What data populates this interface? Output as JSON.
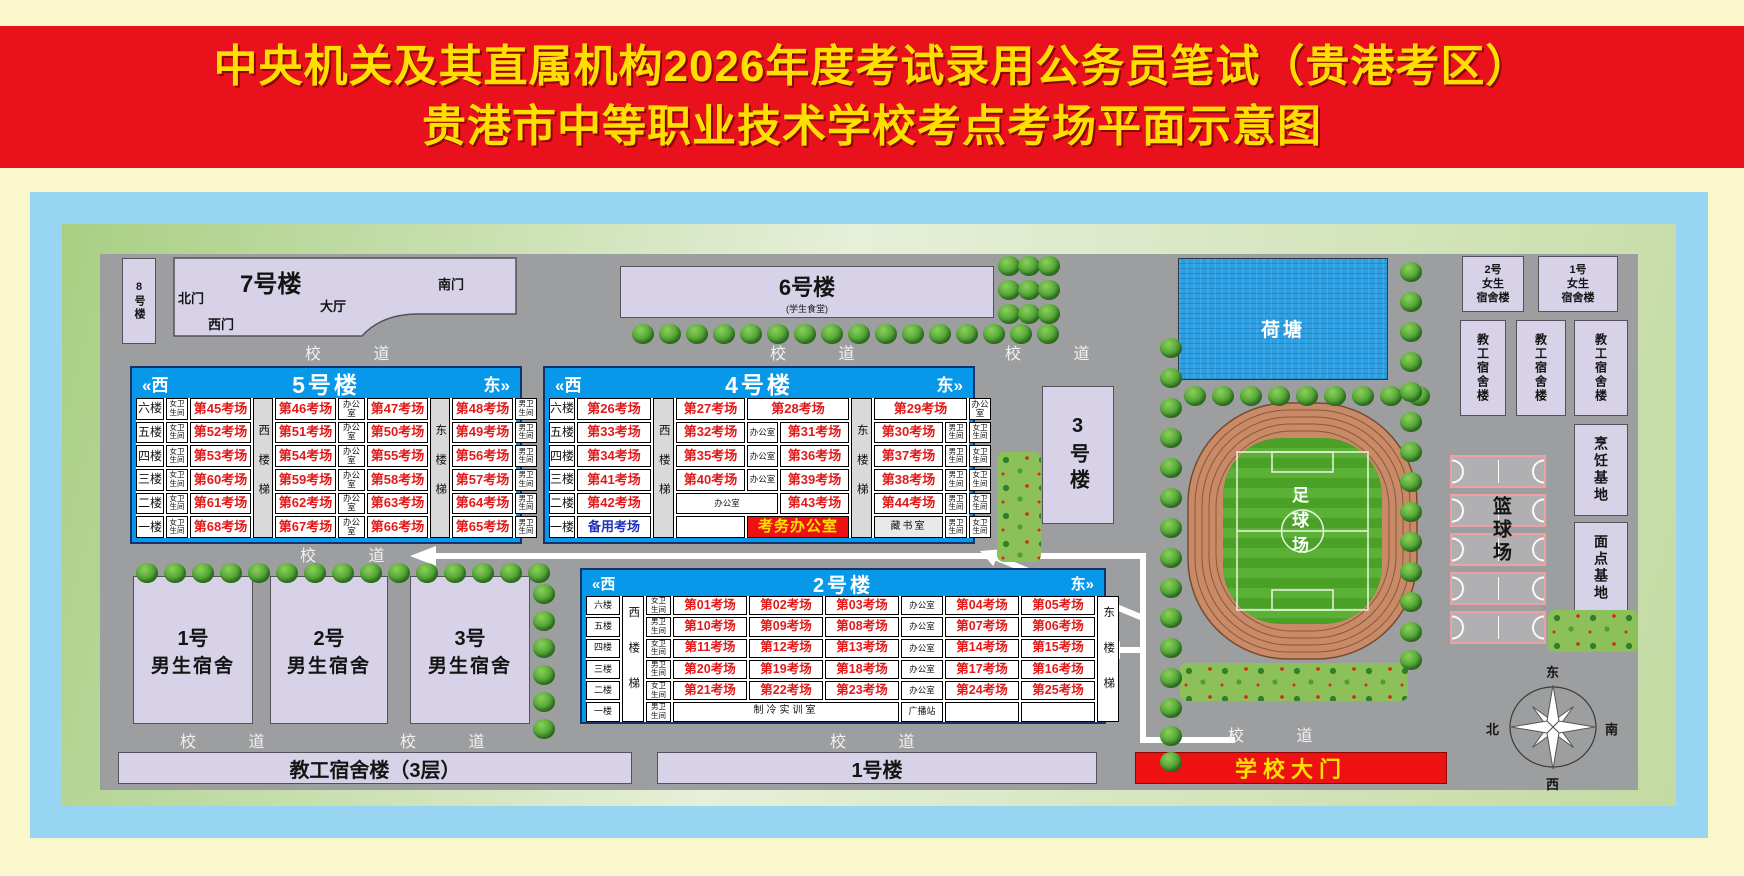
{
  "title": {
    "line1": "中央机关及其直属机构2026年度考试录用公务员笔试（贵港考区）",
    "line2": "贵港市中等职业技术学校考点考场平面示意图"
  },
  "road_label": "校 道",
  "compass": {
    "east": "东",
    "north": "北",
    "south": "南",
    "west": "西"
  },
  "colors": {
    "banner_red": "#E9121C",
    "title_yellow": "#FFDF00",
    "table_blue": "#0898EA",
    "room_red": "#E21A1A",
    "gate_red": "#ED1111",
    "building_fill": "#D7D2E7",
    "campus_gray": "#9C9EA0"
  },
  "buildings": {
    "b8": "8号楼",
    "b7": "7号楼",
    "b7_north_gate": "北门",
    "b7_west_gate": "西门",
    "b7_hall": "大厅",
    "b7_south_gate": "南门",
    "b6": "6号楼",
    "b6_note": "(学生食堂)",
    "b3": "3号楼",
    "pond": "荷塘",
    "football_field": "足球场",
    "basketball_court": "篮球场",
    "dorm_m1_no": "1号",
    "dorm_m2_no": "2号",
    "dorm_m3_no": "3号",
    "dorm_m_label": "男生宿舍",
    "dorm_f1_no": "1号",
    "dorm_f2_no": "2号",
    "dorm_f_line2": "女生",
    "dorm_f_line3": "宿舍楼",
    "staff_dorm": "教工宿舍楼",
    "cooking_base": "烹饪基地",
    "pastry_base": "面点基地",
    "teacher_dorm_bar": "教工宿舍楼（3层）",
    "b1_bar": "1号楼",
    "school_gate": "学校大门"
  },
  "b5": {
    "name": "5号楼",
    "west": "«西",
    "east": "东»",
    "cols": [
      28,
      22,
      61,
      20,
      61,
      27,
      61,
      20,
      61,
      22
    ],
    "stairs": [
      {
        "col": 4,
        "t": "西楼梯"
      },
      {
        "col": 8,
        "t": "东楼梯"
      }
    ],
    "rows": [
      [
        {
          "c": 1,
          "k": "floor",
          "t": "六楼"
        },
        {
          "c": 2,
          "k": "wc",
          "t": "女卫生间"
        },
        {
          "c": 3,
          "k": "room",
          "t": "第45考场"
        },
        {
          "c": 5,
          "k": "room",
          "t": "第46考场"
        },
        {
          "c": 6,
          "k": "office",
          "t": "办公室"
        },
        {
          "c": 7,
          "k": "room",
          "t": "第47考场"
        },
        {
          "c": 9,
          "k": "room",
          "t": "第48考场"
        },
        {
          "c": 10,
          "k": "wc",
          "t": "男卫生间"
        }
      ],
      [
        {
          "c": 1,
          "k": "floor",
          "t": "五楼"
        },
        {
          "c": 2,
          "k": "wc",
          "t": "女卫生间"
        },
        {
          "c": 3,
          "k": "room",
          "t": "第52考场"
        },
        {
          "c": 5,
          "k": "room",
          "t": "第51考场"
        },
        {
          "c": 6,
          "k": "office",
          "t": "办公室"
        },
        {
          "c": 7,
          "k": "room",
          "t": "第50考场"
        },
        {
          "c": 9,
          "k": "room",
          "t": "第49考场"
        },
        {
          "c": 10,
          "k": "wc",
          "t": "男卫生间"
        }
      ],
      [
        {
          "c": 1,
          "k": "floor",
          "t": "四楼"
        },
        {
          "c": 2,
          "k": "wc",
          "t": "女卫生间"
        },
        {
          "c": 3,
          "k": "room",
          "t": "第53考场"
        },
        {
          "c": 5,
          "k": "room",
          "t": "第54考场"
        },
        {
          "c": 6,
          "k": "office",
          "t": "办公室"
        },
        {
          "c": 7,
          "k": "room",
          "t": "第55考场"
        },
        {
          "c": 9,
          "k": "room",
          "t": "第56考场"
        },
        {
          "c": 10,
          "k": "wc",
          "t": "男卫生间"
        }
      ],
      [
        {
          "c": 1,
          "k": "floor",
          "t": "三楼"
        },
        {
          "c": 2,
          "k": "wc",
          "t": "女卫生间"
        },
        {
          "c": 3,
          "k": "room",
          "t": "第60考场"
        },
        {
          "c": 5,
          "k": "room",
          "t": "第59考场"
        },
        {
          "c": 6,
          "k": "office",
          "t": "办公室"
        },
        {
          "c": 7,
          "k": "room",
          "t": "第58考场"
        },
        {
          "c": 9,
          "k": "room",
          "t": "第57考场"
        },
        {
          "c": 10,
          "k": "wc",
          "t": "男卫生间"
        }
      ],
      [
        {
          "c": 1,
          "k": "floor",
          "t": "二楼"
        },
        {
          "c": 2,
          "k": "wc",
          "t": "女卫生间"
        },
        {
          "c": 3,
          "k": "room",
          "t": "第61考场"
        },
        {
          "c": 5,
          "k": "room",
          "t": "第62考场"
        },
        {
          "c": 6,
          "k": "office",
          "t": "办公室"
        },
        {
          "c": 7,
          "k": "room",
          "t": "第63考场"
        },
        {
          "c": 9,
          "k": "room",
          "t": "第64考场"
        },
        {
          "c": 10,
          "k": "wc",
          "t": "男卫生间"
        }
      ],
      [
        {
          "c": 1,
          "k": "floor",
          "t": "一楼"
        },
        {
          "c": 2,
          "k": "wc",
          "t": "女卫生间"
        },
        {
          "c": 3,
          "k": "room",
          "t": "第68考场"
        },
        {
          "c": 5,
          "k": "room",
          "t": "第67考场"
        },
        {
          "c": 6,
          "k": "office",
          "t": "办公室"
        },
        {
          "c": 7,
          "k": "room",
          "t": "第66考场"
        },
        {
          "c": 9,
          "k": "room",
          "t": "第65考场"
        },
        {
          "c": 10,
          "k": "wc",
          "t": "男卫生间"
        }
      ]
    ]
  },
  "b4": {
    "name": "4号楼",
    "west": "«西",
    "east": "东»",
    "cols": [
      26,
      74,
      21,
      69,
      31,
      69,
      21,
      69,
      22,
      22
    ],
    "stairs": [
      {
        "col": 3,
        "t": "西楼梯"
      },
      {
        "col": 7,
        "t": "东楼梯"
      }
    ],
    "rows": [
      [
        {
          "c": 1,
          "k": "floor",
          "t": "六楼"
        },
        {
          "c": 2,
          "k": "room",
          "t": "第26考场"
        },
        {
          "c": 4,
          "k": "room",
          "t": "第27考场"
        },
        {
          "c": 5,
          "s": 2,
          "k": "room",
          "t": "第28考场"
        },
        {
          "c": 8,
          "s": 2,
          "k": "room",
          "t": "第29考场"
        },
        {
          "c": 10,
          "k": "office",
          "t": "办公室"
        }
      ],
      [
        {
          "c": 1,
          "k": "floor",
          "t": "五楼"
        },
        {
          "c": 2,
          "k": "room",
          "t": "第33考场"
        },
        {
          "c": 4,
          "k": "room",
          "t": "第32考场"
        },
        {
          "c": 5,
          "k": "office",
          "t": "办公室"
        },
        {
          "c": 6,
          "k": "room",
          "t": "第31考场"
        },
        {
          "c": 8,
          "k": "room",
          "t": "第30考场"
        },
        {
          "c": 9,
          "k": "wc",
          "t": "男卫生间"
        },
        {
          "c": 10,
          "k": "wc",
          "t": "女卫生间"
        }
      ],
      [
        {
          "c": 1,
          "k": "floor",
          "t": "四楼"
        },
        {
          "c": 2,
          "k": "room",
          "t": "第34考场"
        },
        {
          "c": 4,
          "k": "room",
          "t": "第35考场"
        },
        {
          "c": 5,
          "k": "office",
          "t": "办公室"
        },
        {
          "c": 6,
          "k": "room",
          "t": "第36考场"
        },
        {
          "c": 8,
          "k": "room",
          "t": "第37考场"
        },
        {
          "c": 9,
          "k": "wc",
          "t": "男卫生间"
        },
        {
          "c": 10,
          "k": "wc",
          "t": "女卫生间"
        }
      ],
      [
        {
          "c": 1,
          "k": "floor",
          "t": "三楼"
        },
        {
          "c": 2,
          "k": "room",
          "t": "第41考场"
        },
        {
          "c": 4,
          "k": "room",
          "t": "第40考场"
        },
        {
          "c": 5,
          "k": "office",
          "t": "办公室"
        },
        {
          "c": 6,
          "k": "room",
          "t": "第39考场"
        },
        {
          "c": 8,
          "k": "room",
          "t": "第38考场"
        },
        {
          "c": 9,
          "k": "wc",
          "t": "男卫生间"
        },
        {
          "c": 10,
          "k": "wc",
          "t": "女卫生间"
        }
      ],
      [
        {
          "c": 1,
          "k": "floor",
          "t": "二楼"
        },
        {
          "c": 2,
          "k": "room",
          "t": "第42考场"
        },
        {
          "c": 4,
          "s": 2,
          "k": "office",
          "t": "办公室"
        },
        {
          "c": 6,
          "k": "room",
          "t": "第43考场"
        },
        {
          "c": 8,
          "k": "room",
          "t": "第44考场"
        },
        {
          "c": 9,
          "k": "wc",
          "t": "男卫生间"
        },
        {
          "c": 10,
          "k": "wc",
          "t": "女卫生间"
        }
      ],
      [
        {
          "c": 1,
          "k": "floor",
          "t": "一楼"
        },
        {
          "c": 2,
          "k": "reserve",
          "t": "备用考场"
        },
        {
          "c": 4,
          "k": "blank",
          "t": ""
        },
        {
          "c": 5,
          "s": 2,
          "k": "kaowu",
          "t": "考务办公室"
        },
        {
          "c": 8,
          "k": "library",
          "t": "藏书室"
        },
        {
          "c": 9,
          "k": "wc",
          "t": "男卫生间"
        },
        {
          "c": 10,
          "k": "wc",
          "t": "女卫生间"
        }
      ]
    ]
  },
  "b2": {
    "name": "2号楼",
    "west": "«西",
    "east": "东»",
    "cols": [
      34,
      22,
      25,
      74,
      74,
      74,
      42,
      74,
      74,
      22
    ],
    "stairs": [
      {
        "col": 2,
        "t": "西楼梯"
      },
      {
        "col": 10,
        "t": "东楼梯"
      }
    ],
    "rows": [
      [
        {
          "c": 1,
          "k": "floor",
          "t": "六楼"
        },
        {
          "c": 3,
          "k": "wc",
          "t": "女卫生间"
        },
        {
          "c": 4,
          "k": "room",
          "t": "第01考场"
        },
        {
          "c": 5,
          "k": "room",
          "t": "第02考场"
        },
        {
          "c": 6,
          "k": "room",
          "t": "第03考场"
        },
        {
          "c": 7,
          "k": "office",
          "t": "办公室"
        },
        {
          "c": 8,
          "k": "room",
          "t": "第04考场"
        },
        {
          "c": 9,
          "k": "room",
          "t": "第05考场"
        }
      ],
      [
        {
          "c": 1,
          "k": "floor",
          "t": "五楼"
        },
        {
          "c": 3,
          "k": "wc",
          "t": "男卫生间"
        },
        {
          "c": 4,
          "k": "room",
          "t": "第10考场"
        },
        {
          "c": 5,
          "k": "room",
          "t": "第09考场"
        },
        {
          "c": 6,
          "k": "room",
          "t": "第08考场"
        },
        {
          "c": 7,
          "k": "office",
          "t": "办公室"
        },
        {
          "c": 8,
          "k": "room",
          "t": "第07考场"
        },
        {
          "c": 9,
          "k": "room",
          "t": "第06考场"
        }
      ],
      [
        {
          "c": 1,
          "k": "floor",
          "t": "四楼"
        },
        {
          "c": 3,
          "k": "wc",
          "t": "女卫生间"
        },
        {
          "c": 4,
          "k": "room",
          "t": "第11考场"
        },
        {
          "c": 5,
          "k": "room",
          "t": "第12考场"
        },
        {
          "c": 6,
          "k": "room",
          "t": "第13考场"
        },
        {
          "c": 7,
          "k": "office",
          "t": "办公室"
        },
        {
          "c": 8,
          "k": "room",
          "t": "第14考场"
        },
        {
          "c": 9,
          "k": "room",
          "t": "第15考场"
        }
      ],
      [
        {
          "c": 1,
          "k": "floor",
          "t": "三楼"
        },
        {
          "c": 3,
          "k": "wc",
          "t": "男卫生间"
        },
        {
          "c": 4,
          "k": "room",
          "t": "第20考场"
        },
        {
          "c": 5,
          "k": "room",
          "t": "第19考场"
        },
        {
          "c": 6,
          "k": "room",
          "t": "第18考场"
        },
        {
          "c": 7,
          "k": "office",
          "t": "办公室"
        },
        {
          "c": 8,
          "k": "room",
          "t": "第17考场"
        },
        {
          "c": 9,
          "k": "room",
          "t": "第16考场"
        }
      ],
      [
        {
          "c": 1,
          "k": "floor",
          "t": "二楼"
        },
        {
          "c": 3,
          "k": "wc",
          "t": "女卫生间"
        },
        {
          "c": 4,
          "k": "room",
          "t": "第21考场"
        },
        {
          "c": 5,
          "k": "room",
          "t": "第22考场"
        },
        {
          "c": 6,
          "k": "room",
          "t": "第23考场"
        },
        {
          "c": 7,
          "k": "office",
          "t": "办公室"
        },
        {
          "c": 8,
          "k": "room",
          "t": "第24考场"
        },
        {
          "c": 9,
          "k": "room",
          "t": "第25考场"
        }
      ],
      [
        {
          "c": 1,
          "k": "floor",
          "t": "一楼"
        },
        {
          "c": 3,
          "k": "wc",
          "t": "男卫生间"
        },
        {
          "c": 4,
          "s": 3,
          "k": "lab",
          "t": "制冷实训室"
        },
        {
          "c": 7,
          "k": "radio",
          "t": "广播站"
        },
        {
          "c": 8,
          "k": "blank",
          "t": ""
        },
        {
          "c": 9,
          "k": "blank",
          "t": ""
        }
      ]
    ]
  }
}
